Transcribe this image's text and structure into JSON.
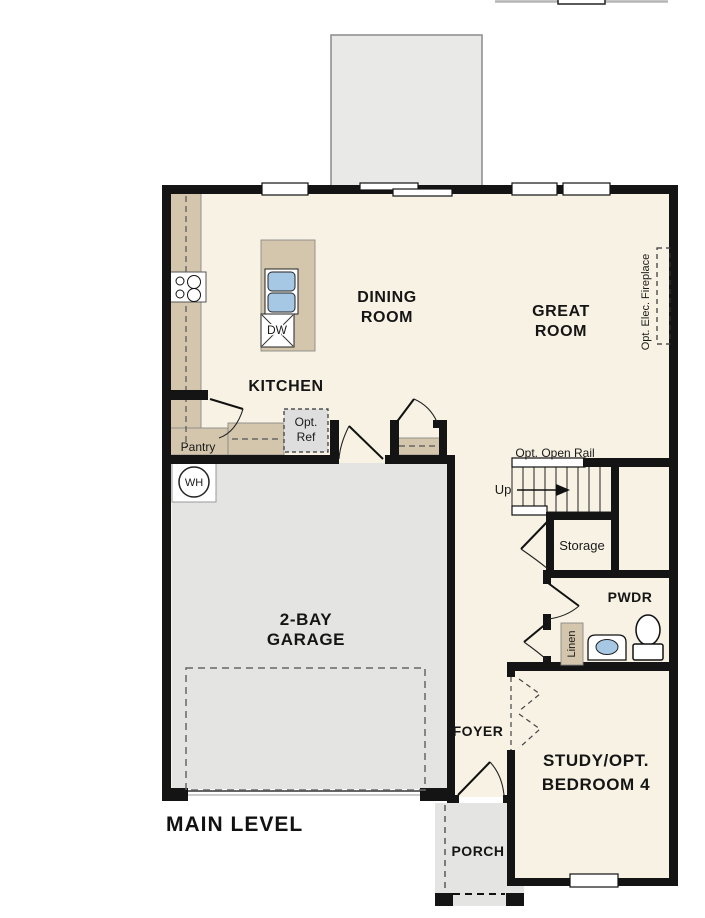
{
  "page": {
    "level_label": "MAIN LEVEL"
  },
  "rooms": {
    "dining": {
      "line1": "DINING",
      "line2": "ROOM"
    },
    "great": {
      "line1": "GREAT",
      "line2": "ROOM"
    },
    "kitchen": {
      "label": "KITCHEN"
    },
    "garage": {
      "line1": "2-BAY",
      "line2": "GARAGE"
    },
    "study": {
      "line1": "STUDY/OPT.",
      "line2": "BEDROOM 4"
    },
    "foyer": {
      "label": "FOYER"
    },
    "porch": {
      "label": "PORCH"
    },
    "pwdr": {
      "label": "PWDR"
    },
    "storage": {
      "label": "Storage"
    },
    "pantry": {
      "label": "Pantry"
    },
    "linen": {
      "label": "Linen"
    }
  },
  "annotations": {
    "opt_open_rail": "Opt. Open Rail",
    "up": "Up",
    "opt_ref_line1": "Opt.",
    "opt_ref_line2": "Ref",
    "opt_elec_fireplace": "Opt. Elec. Fireplace",
    "water_heater": "WH",
    "dishwasher": "DW"
  },
  "colors": {
    "interior": "#f7f2e3",
    "wall": "#141414",
    "counter": "#d3c6ac",
    "garage_floor": "#e4e4e3",
    "deck": "#e9e9e8",
    "porch": "#e4e4e3",
    "optional_gray": "#dedede",
    "appliance_blue": "#a6c8e4"
  }
}
